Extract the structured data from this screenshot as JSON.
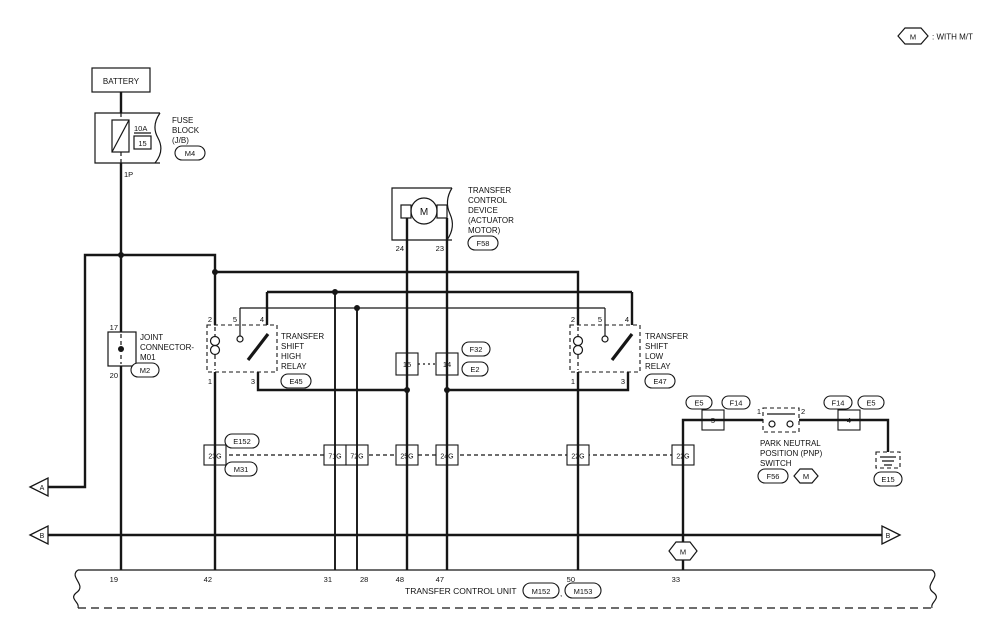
{
  "colors": {
    "line": "#161616",
    "background": "#ffffff"
  },
  "legend": {
    "marker": "M",
    "label": ": WITH M/T"
  },
  "battery": {
    "label": "BATTERY"
  },
  "fuse_block": {
    "amp": "10A",
    "fuse_no": "15",
    "lines": [
      "FUSE",
      "BLOCK",
      "(J/B)"
    ],
    "connector": "M4",
    "wire": "1P"
  },
  "joint_connector": {
    "pin_top": "17",
    "pin_bottom": "20",
    "lines": [
      "JOINT",
      "CONNECTOR-",
      "M01"
    ],
    "connector": "M2"
  },
  "motor": {
    "symbol": "M",
    "lines": [
      "TRANSFER",
      "CONTROL",
      "DEVICE",
      "(ACTUATOR",
      "MOTOR)"
    ],
    "connector": "F58",
    "pin_left": "24",
    "pin_right": "23"
  },
  "relay_high": {
    "pins": {
      "p2": "2",
      "p5": "5",
      "p4": "4",
      "p1": "1",
      "p3": "3"
    },
    "lines": [
      "TRANSFER",
      "SHIFT",
      "HIGH",
      "RELAY"
    ],
    "connector": "E45"
  },
  "relay_low": {
    "pins": {
      "p2": "2",
      "p5": "5",
      "p4": "4",
      "p1": "1",
      "p3": "3"
    },
    "lines": [
      "TRANSFER",
      "SHIFT",
      "LOW",
      "RELAY"
    ],
    "connector": "E47"
  },
  "mid_connectors": {
    "left_pin": "15",
    "right_pin": "14",
    "oval_top": "F32",
    "oval_bottom": "E2"
  },
  "connector_row": {
    "oval_top": "E152",
    "oval_bottom": "M31",
    "boxes": [
      "23G",
      "71G",
      "72G",
      "25G",
      "24G",
      "22G",
      "22G"
    ]
  },
  "pnp": {
    "ovals_left": [
      "E5",
      "F14"
    ],
    "ovals_right": [
      "F14",
      "E5"
    ],
    "box_left": "5",
    "box_right": "4",
    "pin_left": "1",
    "pin_right": "2",
    "lines": [
      "PARK NEUTRAL",
      "POSITION (PNP)",
      "SWITCH"
    ],
    "connector": "F56",
    "mt_marker": "M",
    "ground_connector": "E15"
  },
  "branch_marker": {
    "label": "M"
  },
  "tcu": {
    "label": "TRANSFER CONTROL UNIT",
    "separator": ",",
    "connectors": [
      "M152",
      "M153"
    ],
    "pins": [
      "19",
      "42",
      "31",
      "28",
      "48",
      "47",
      "50",
      "33"
    ]
  },
  "arrows": {
    "a": "A",
    "b_left": "B",
    "b_right": "B"
  }
}
